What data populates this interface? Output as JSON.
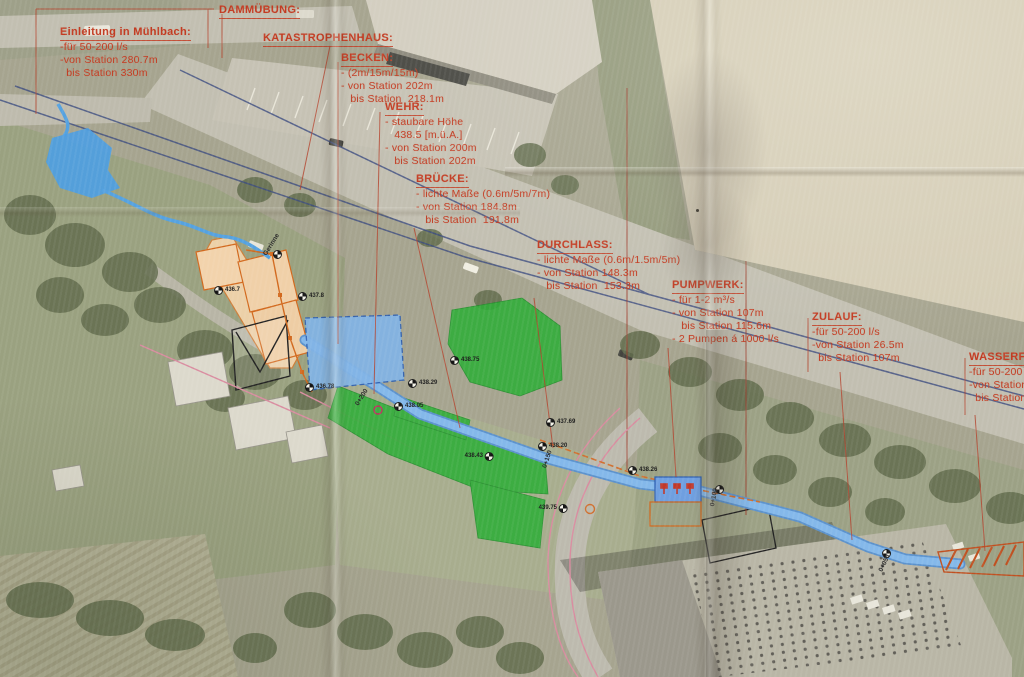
{
  "colors": {
    "paper": "#d5cdb6",
    "annotation_red": "#c23b22",
    "overlay_green": "#2fae38",
    "water_blue": "#6aade4",
    "basin_blue": "#82b4e6",
    "construction_orange": "#d2691e",
    "pipeline_navy": "#3c4c80",
    "pink_line": "#d98ca0"
  },
  "map": {
    "annotation_blocks": [
      {
        "id": "einleitung",
        "x": 60,
        "y": 24,
        "title": "Einleitung in Mühlbach:",
        "lines": [
          "-für 50-200 l/s",
          "-von Station 280.7m",
          "  bis Station 330m"
        ]
      },
      {
        "id": "dammuebung",
        "x": 219,
        "y": 2,
        "title": "DAMMÜBUNG:",
        "lines": []
      },
      {
        "id": "katastrophenhaus",
        "x": 263,
        "y": 30,
        "title": "KATASTROPHENHAUS:",
        "lines": []
      },
      {
        "id": "becken",
        "x": 341,
        "y": 50,
        "title": "BECKEN:",
        "lines": [
          "- (2m/15m/15m)",
          "- von Station 202m",
          "   bis Station  218.1m"
        ]
      },
      {
        "id": "wehr",
        "x": 385,
        "y": 99,
        "title": "WEHR:",
        "lines": [
          "- staubare Höhe",
          "   438.5 [m.ü.A.]",
          "- von Station 200m",
          "   bis Station 202m"
        ]
      },
      {
        "id": "bruecke",
        "x": 416,
        "y": 171,
        "title": "BRÜCKE:",
        "lines": [
          "- lichte Maße (0.6m/5m/7m)",
          "- von Station 184.8m",
          "   bis Station  191.8m"
        ]
      },
      {
        "id": "durchlass",
        "x": 537,
        "y": 237,
        "title": "DURCHLASS:",
        "lines": [
          "- lichte Maße (0.6m/1.5m/5m)",
          "- von Station 148.3m",
          "   bis Station  153.3m"
        ]
      },
      {
        "id": "pumpwerk",
        "x": 672,
        "y": 277,
        "title": "PUMPWERK:",
        "lines": [
          "- für 1-2 m³/s",
          "- von Station 107m",
          "   bis Station 115.6m",
          "- 2 Pumpen á 1000 l/s"
        ]
      },
      {
        "id": "zulauf",
        "x": 812,
        "y": 309,
        "title": "ZULAUF:",
        "lines": [
          "-für 50-200 l/s",
          "-von Station 26.5m",
          "  bis Station 107m"
        ]
      },
      {
        "id": "wasserfassung",
        "x": 969,
        "y": 349,
        "title": "WASSERFA",
        "lines": [
          "-für 50-200 l",
          "-von Station",
          "  bis Station"
        ]
      }
    ],
    "survey_markers": [
      {
        "x": 214,
        "y": 290,
        "value": "436.7",
        "side": "right"
      },
      {
        "x": 298,
        "y": 296,
        "value": "437.8",
        "side": "right"
      },
      {
        "x": 450,
        "y": 360,
        "value": "438.75",
        "side": "right"
      },
      {
        "x": 408,
        "y": 383,
        "value": "438.29",
        "side": "right"
      },
      {
        "x": 305,
        "y": 387,
        "value": "436.78",
        "side": "right"
      },
      {
        "x": 394,
        "y": 406,
        "value": "438.05",
        "side": "right"
      },
      {
        "x": 494,
        "y": 456,
        "value": "438.43",
        "side": "left"
      },
      {
        "x": 546,
        "y": 422,
        "value": "437.69",
        "side": "right"
      },
      {
        "x": 538,
        "y": 446,
        "value": "438.20",
        "side": "right"
      },
      {
        "x": 628,
        "y": 470,
        "value": "438.26",
        "side": "right"
      },
      {
        "x": 568,
        "y": 508,
        "value": "439.75",
        "side": "left"
      },
      {
        "x": 715,
        "y": 489,
        "value": "",
        "side": "right"
      },
      {
        "x": 882,
        "y": 553,
        "value": "",
        "side": "right"
      },
      {
        "x": 273,
        "y": 254,
        "value": "",
        "side": "right"
      }
    ],
    "station_labels": [
      {
        "x": 268,
        "y": 250,
        "text": "Gerinne",
        "rot": -58
      },
      {
        "x": 360,
        "y": 400,
        "text": "0+200",
        "rot": -58
      },
      {
        "x": 548,
        "y": 462,
        "text": "0+150",
        "rot": -72
      },
      {
        "x": 716,
        "y": 500,
        "text": "0+100",
        "rot": -80
      },
      {
        "x": 884,
        "y": 566,
        "text": "0+050",
        "rot": -65
      }
    ]
  }
}
